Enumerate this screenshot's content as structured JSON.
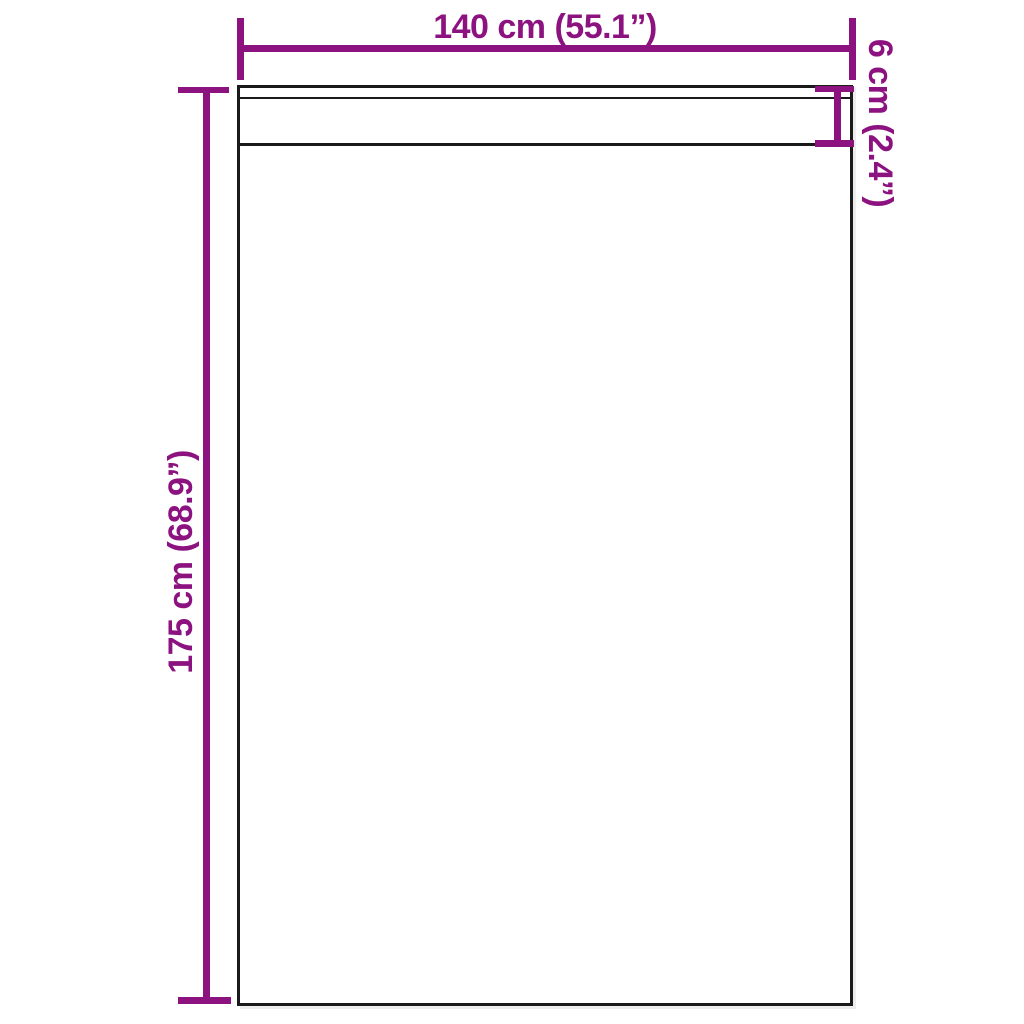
{
  "diagram": {
    "type": "product-dimension-diagram",
    "subject": "curtain-panel-with-header-strip",
    "labels": {
      "width": "140 cm (55.1”)",
      "height": "175 cm (68.9”)",
      "header_height": "6 cm (2.4”)"
    },
    "colors": {
      "dimension_accent": "#8C1280",
      "outline": "#1A1A1A",
      "background": "#FFFFFF"
    }
  }
}
